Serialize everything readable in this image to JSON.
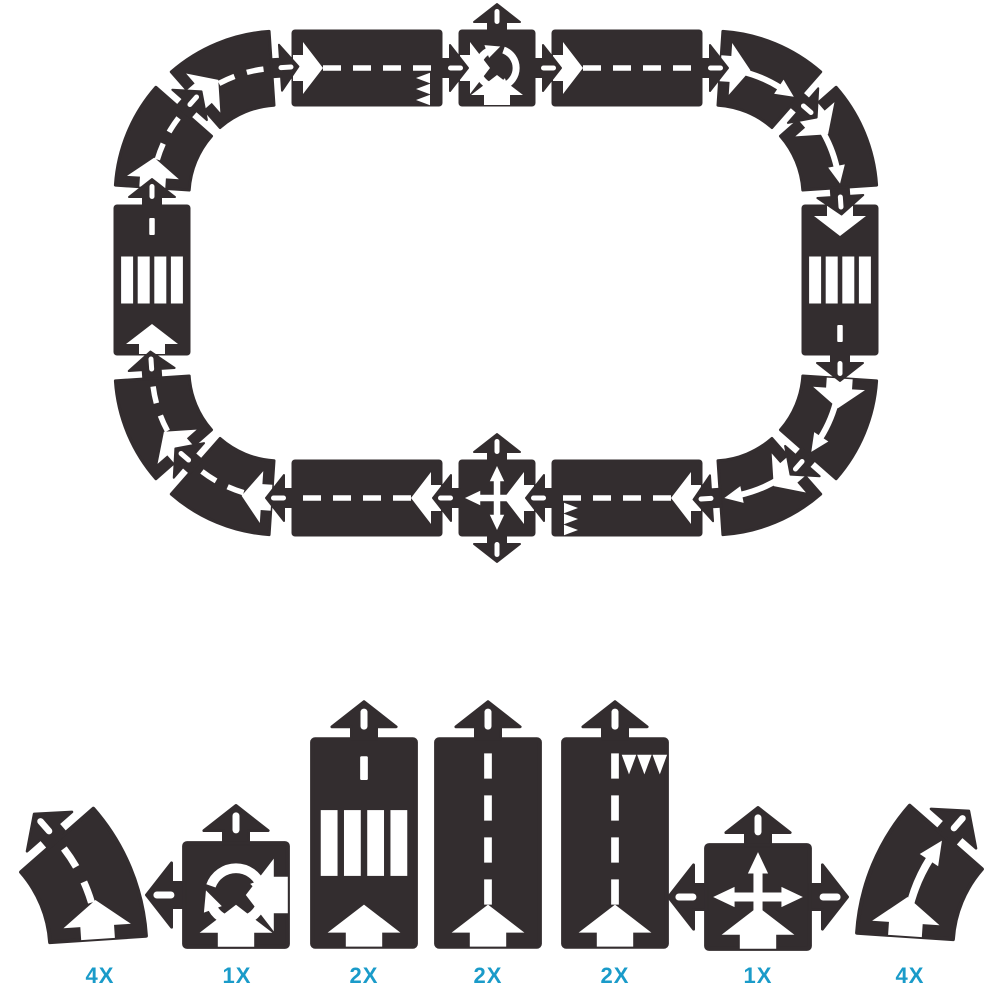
{
  "palette": {
    "road": "#332d2f",
    "marking": "#ffffff",
    "background": "#ffffff",
    "label": "#1a9bc9"
  },
  "track": {
    "name": "assembled-road-loop",
    "pieces": [
      {
        "type": "straight",
        "variant": "crosswalk",
        "x": 152,
        "y": 280,
        "rot": 0
      },
      {
        "type": "curve",
        "variant": "dashed",
        "cx": 280,
        "cy": 196,
        "a0": 180,
        "a1": 225
      },
      {
        "type": "curve",
        "variant": "dashed",
        "cx": 280,
        "cy": 196,
        "a0": 225,
        "a1": 270
      },
      {
        "type": "straight",
        "variant": "giveway",
        "x": 367,
        "y": 68,
        "rot": 90
      },
      {
        "type": "square",
        "variant": "roundabout",
        "x": 497,
        "y": 68,
        "rot": 90
      },
      {
        "type": "straight",
        "variant": "plain",
        "x": 627,
        "y": 68,
        "rot": 90
      },
      {
        "type": "curve",
        "variant": "solid",
        "cx": 712,
        "cy": 196,
        "a0": 270,
        "a1": 315
      },
      {
        "type": "curve",
        "variant": "solid",
        "cx": 712,
        "cy": 196,
        "a0": 315,
        "a1": 360
      },
      {
        "type": "straight",
        "variant": "crosswalk",
        "x": 840,
        "y": 280,
        "rot": 180
      },
      {
        "type": "curve",
        "variant": "solid",
        "cx": 712,
        "cy": 370,
        "a0": 0,
        "a1": 45
      },
      {
        "type": "curve",
        "variant": "solid",
        "cx": 712,
        "cy": 370,
        "a0": 45,
        "a1": 90
      },
      {
        "type": "straight",
        "variant": "plain",
        "x": 367,
        "y": 498,
        "rot": 270
      },
      {
        "type": "square",
        "variant": "intersection",
        "x": 497,
        "y": 498,
        "rot": 270
      },
      {
        "type": "straight",
        "variant": "giveway",
        "x": 627,
        "y": 498,
        "rot": 270,
        "flip": true
      },
      {
        "type": "curve",
        "variant": "dashed",
        "cx": 280,
        "cy": 370,
        "a0": 90,
        "a1": 135
      },
      {
        "type": "curve",
        "variant": "dashed",
        "cx": 280,
        "cy": 370,
        "a0": 135,
        "a1": 180
      }
    ]
  },
  "parts": [
    {
      "name": "curve-piece-left",
      "type": "curve",
      "variant": "dashed",
      "cx": -68,
      "cy": 950,
      "a0": 0,
      "a1": -45,
      "k": 1.3,
      "label": "4X",
      "label_x": 100
    },
    {
      "name": "roundabout-piece",
      "type": "square",
      "variant": "roundabout",
      "x": 236,
      "y": 895,
      "rot": 0,
      "k": 1.4,
      "label": "1X",
      "label_x": 237
    },
    {
      "name": "crosswalk-piece",
      "type": "straight",
      "variant": "crosswalk",
      "x": 364,
      "y": 843,
      "rot": 0,
      "k": 1.4,
      "label": "2X",
      "label_x": 364
    },
    {
      "name": "straight-piece",
      "type": "straight",
      "variant": "plain",
      "x": 488,
      "y": 843,
      "rot": 0,
      "k": 1.4,
      "label": "2X",
      "label_x": 488
    },
    {
      "name": "give-way-piece",
      "type": "straight",
      "variant": "giveway",
      "x": 615,
      "y": 843,
      "rot": 0,
      "k": 1.4,
      "label": "2X",
      "label_x": 615
    },
    {
      "name": "intersection-piece",
      "type": "square",
      "variant": "intersection",
      "x": 758,
      "y": 897,
      "rot": 0,
      "k": 1.4,
      "label": "1X",
      "label_x": 758
    },
    {
      "name": "curve-piece-right",
      "type": "curve",
      "variant": "solid",
      "cx": 1071,
      "cy": 947,
      "a0": 180,
      "a1": 225,
      "k": 1.3,
      "label": "4X",
      "label_x": 910
    }
  ]
}
